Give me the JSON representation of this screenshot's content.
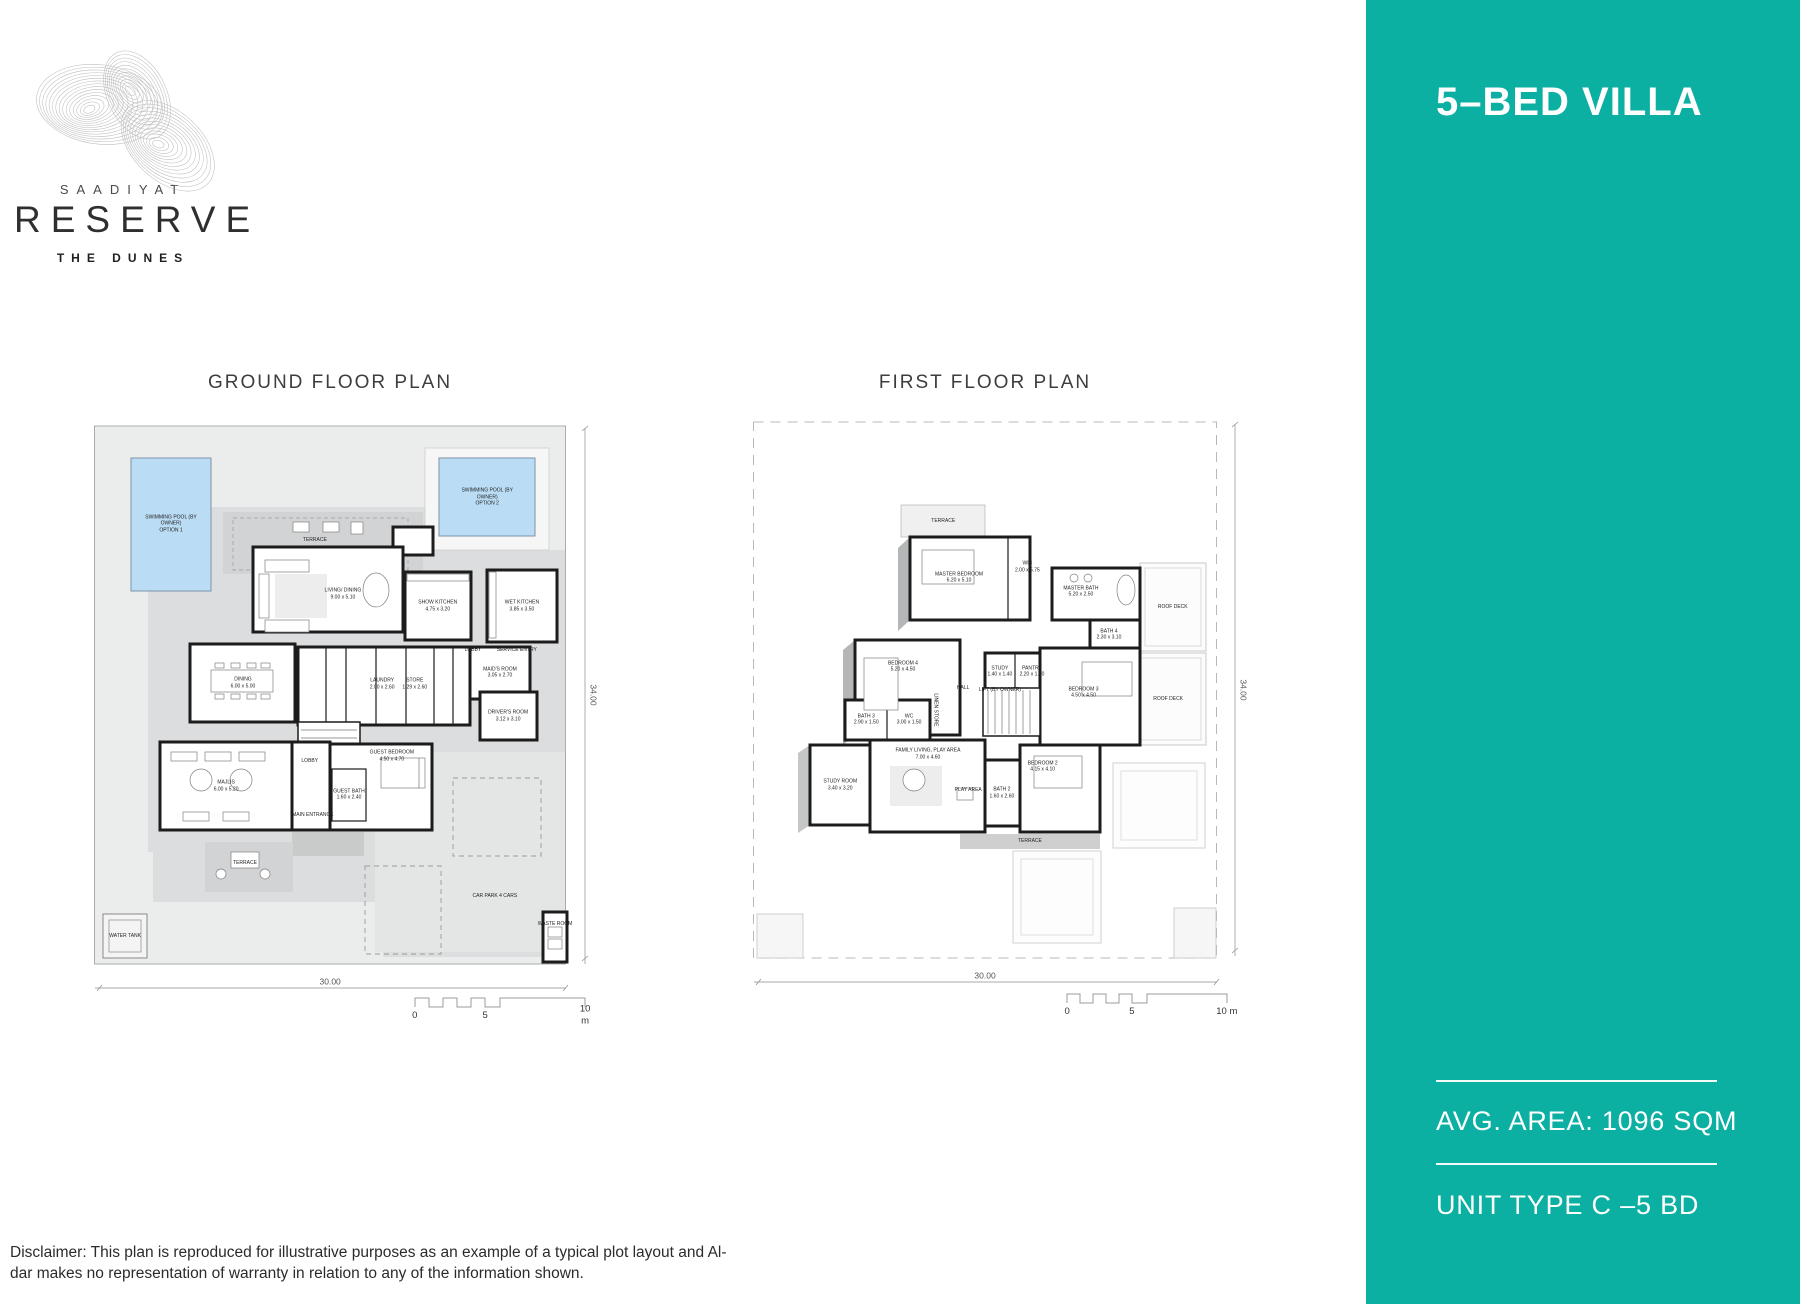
{
  "brand": {
    "name_top": "SAADIYAT",
    "name_main": "RESERVE",
    "name_sub": "THE DUNES"
  },
  "sidebar": {
    "accent_color": "#0cb0a3",
    "title": "5–BED VILLA",
    "avg_area": "AVG. AREA: 1096 SQM",
    "unit_type": "UNIT TYPE C –5 BD"
  },
  "disclaimer": {
    "line1": "Disclaimer: This plan is reproduced for illustrative purposes as an example of a typical plot layout and Al-",
    "line2": "dar makes no representation of warranty in relation to any of the information shown."
  },
  "plans": [
    {
      "title": "GROUND FLOOR PLAN",
      "plot_width_m": "30.00",
      "plot_height_m": "34.00",
      "labels": [
        {
          "t": "SWIMMING POOL (BY\nOWNER)\nOPTION 1",
          "x": 15.3,
          "y": 16.7
        },
        {
          "t": "SWIMMING POOL (BY\nOWNER)\nOPTION 2",
          "x": 77.3,
          "y": 12.3
        },
        {
          "t": "TERRACE",
          "x": 43.5,
          "y": 19.3
        },
        {
          "t": "LIVING/ DINING\n9.00 x 5.10",
          "x": 49.0,
          "y": 28.2
        },
        {
          "t": "SHOW KITCHEN\n4.75 x 3.20",
          "x": 67.6,
          "y": 30.2
        },
        {
          "t": "WET KITCHEN\n3.85 x 3.50",
          "x": 84.1,
          "y": 30.2
        },
        {
          "t": "LOBBY",
          "x": 74.5,
          "y": 37.4
        },
        {
          "t": "SERVICE ENTRY",
          "x": 83.1,
          "y": 37.4
        },
        {
          "t": "DINING\n6.00 x 5.00",
          "x": 29.4,
          "y": 42.8
        },
        {
          "t": "LAUNDRY\n2.00 x 2.60",
          "x": 56.7,
          "y": 43.0
        },
        {
          "t": "STORE\n1.29 x 2.60",
          "x": 63.1,
          "y": 43.0
        },
        {
          "t": "MAID'S ROOM\n3.05 x 2.70",
          "x": 79.8,
          "y": 41.1
        },
        {
          "t": "DRIVER'S ROOM\n3.12 x 3.10",
          "x": 81.4,
          "y": 48.2
        },
        {
          "t": "MAJLIS\n6.00 x 5.20",
          "x": 26.1,
          "y": 59.7
        },
        {
          "t": "LOBBY",
          "x": 42.5,
          "y": 55.5
        },
        {
          "t": "GUEST BEDROOM\n4.50 x 4.70",
          "x": 58.6,
          "y": 54.8
        },
        {
          "t": "GUEST BATH\n1.60 x 2.40",
          "x": 50.2,
          "y": 61.1
        },
        {
          "t": "MAIN ENTRANCE",
          "x": 43.1,
          "y": 64.4
        },
        {
          "t": "TERRACE",
          "x": 29.8,
          "y": 72.3
        },
        {
          "t": "CAR PARK  4 CARS",
          "x": 78.8,
          "y": 77.7
        },
        {
          "t": "WATER TANK",
          "x": 6.3,
          "y": 84.3
        },
        {
          "t": "WASTE ROOM",
          "x": 90.6,
          "y": 82.3
        },
        {
          "t": "30.00",
          "x": 46.5,
          "y": 91.8,
          "cls": "dim"
        },
        {
          "t": "34.00",
          "x": 98.0,
          "y": 44.8,
          "cls": "dim",
          "r": 90
        },
        {
          "t": "0",
          "x": 63.1,
          "y": 97.4,
          "cls": "scale"
        },
        {
          "t": "5",
          "x": 76.9,
          "y": 97.4,
          "cls": "scale"
        },
        {
          "t": "10 m",
          "x": 96.5,
          "y": 97.4,
          "cls": "scale"
        }
      ]
    },
    {
      "title": "FIRST FLOOR PLAN",
      "plot_width_m": "30.00",
      "plot_height_m": "34.00",
      "labels": [
        {
          "t": "TERRACE",
          "x": 37.5,
          "y": 16.9
        },
        {
          "t": "MASTER BEDROOM\n6.20 x 5.10",
          "x": 40.6,
          "y": 26.2
        },
        {
          "t": "WIC\n2.00 x 5.75",
          "x": 54.0,
          "y": 24.5
        },
        {
          "t": "MASTER BATH\n5.20 x 2.50",
          "x": 64.5,
          "y": 28.5
        },
        {
          "t": "BATH 4\n2.30 x 3.10",
          "x": 70.0,
          "y": 35.5
        },
        {
          "t": "ROOF DECK",
          "x": 82.5,
          "y": 31.0
        },
        {
          "t": "ROOF DECK",
          "x": 81.6,
          "y": 46.1
        },
        {
          "t": "BEDROOM 4\n5.20 x 4.50",
          "x": 29.6,
          "y": 40.8
        },
        {
          "t": "HALL",
          "x": 41.4,
          "y": 44.3
        },
        {
          "t": "STUDY\n1.40 x 1.40",
          "x": 48.6,
          "y": 41.6
        },
        {
          "t": "PANTRY\n2.20 x 1.60",
          "x": 54.9,
          "y": 41.6
        },
        {
          "t": "LIFT (BY OWNER)",
          "x": 48.6,
          "y": 44.6
        },
        {
          "t": "BEDROOM 3\n4.50 x 4.50",
          "x": 65.0,
          "y": 45.0
        },
        {
          "t": "BATH 3\n2.90 x 1.50",
          "x": 22.4,
          "y": 49.5
        },
        {
          "t": "WC\n3.00 x 1.50",
          "x": 30.8,
          "y": 49.5
        },
        {
          "t": "LINEN STORE",
          "x": 35.9,
          "y": 47.9,
          "r": 90
        },
        {
          "t": "STUDY ROOM\n3.40 x 3.20",
          "x": 17.3,
          "y": 60.2
        },
        {
          "t": "FAMILY LIVING, PLAY AREA\n7.00 x 4.60",
          "x": 34.5,
          "y": 55.1
        },
        {
          "t": "PLAY AREA",
          "x": 42.4,
          "y": 61.0
        },
        {
          "t": "BATH 2\n1.60 x 2.60",
          "x": 49.0,
          "y": 61.5
        },
        {
          "t": "BEDROOM 2\n4.15 x 4.10",
          "x": 57.0,
          "y": 57.2
        },
        {
          "t": "TERRACE",
          "x": 54.5,
          "y": 69.3
        },
        {
          "t": "30.00",
          "x": 45.7,
          "y": 91.5,
          "cls": "dim"
        },
        {
          "t": "34.00",
          "x": 96.3,
          "y": 44.6,
          "cls": "dim",
          "r": 90
        },
        {
          "t": "0",
          "x": 61.8,
          "y": 97.4,
          "cls": "scale"
        },
        {
          "t": "5",
          "x": 74.5,
          "y": 97.4,
          "cls": "scale"
        },
        {
          "t": "10 m",
          "x": 93.1,
          "y": 97.4,
          "cls": "scale"
        }
      ]
    }
  ]
}
